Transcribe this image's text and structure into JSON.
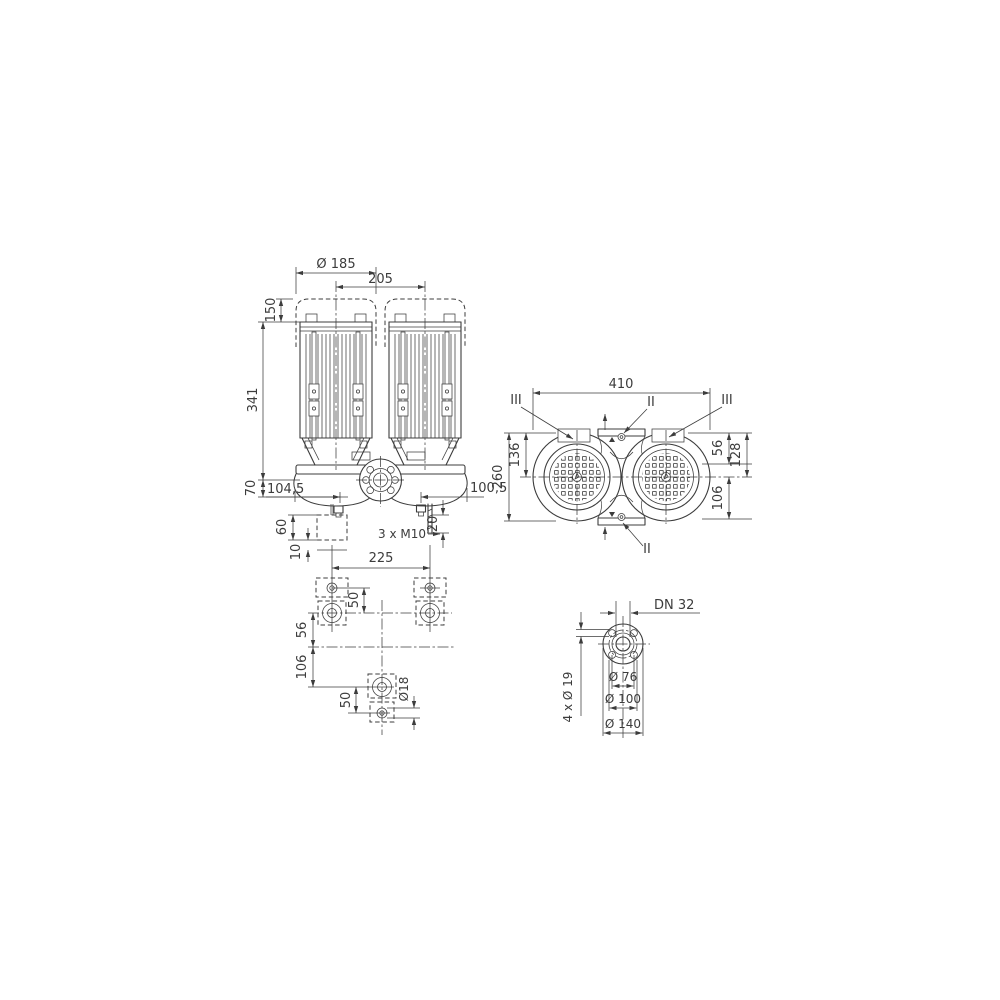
{
  "meta": {
    "background": "#ffffff",
    "line_color": "#3c3c3c",
    "drawing_type": "dimensional-drawing-twin-head-inline-pump"
  },
  "front": {
    "dia": "Ø 185",
    "pitch": "205",
    "h_cap": "150",
    "h_motor": "341",
    "h_base": "70",
    "off_left": "104,5",
    "off_right": "100,5",
    "block_h": "60",
    "grout": "10",
    "stud_len": "20",
    "studs": "3 x M10"
  },
  "top": {
    "width": "410",
    "depth": "260",
    "front_to_axis": "136",
    "edge_to_port": "56",
    "edge_to_axis": "128",
    "axis_to_edge": "106",
    "section_ii": "II",
    "section_iii": "III"
  },
  "foundation": {
    "bolt_span": "225",
    "pair_pitch_top": "50",
    "axis_top": "56",
    "axis_bottom": "106",
    "pair_pitch_bottom": "50",
    "hole_dia": "Ø18"
  },
  "flange": {
    "nominal": "DN 32",
    "bolt_holes": "4 x Ø 19",
    "raised_face": "Ø 76",
    "bolt_circle": "Ø 100",
    "outer": "Ø 140"
  }
}
